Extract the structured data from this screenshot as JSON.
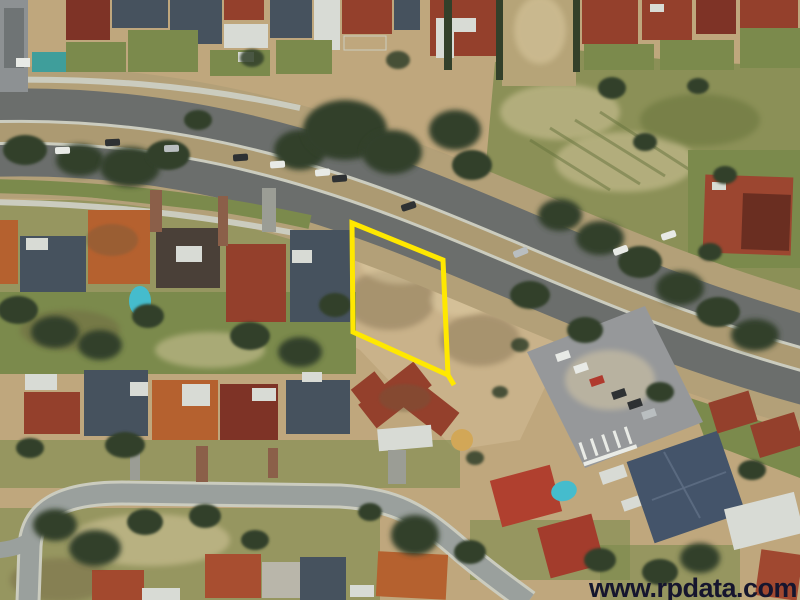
{
  "watermark": {
    "text": "www.rpdata.com"
  },
  "parcel": {
    "points": "352,223 443,260 448,375 353,332",
    "tick_d": "M448,375 L454,385"
  },
  "colors": {
    "ground": "#bfa77d",
    "grass-field": "#8b9057",
    "lot-dirt": "#c9b28a",
    "lawn": "#7b8a4c",
    "tree": "#33402a",
    "road-asphalt": "#6b6e6c",
    "verge-dirt": "#b3a078",
    "median-dirt": "#ac9a72",
    "curb-light": "#cbccbf",
    "street-asphalt": "#9aa09d",
    "parking": "#96989a",
    "building-roof": "#44546a",
    "pool": "#45bccd",
    "roof-red": "#94402c",
    "roof-terracotta": "#b5612f",
    "roof-maroon": "#7e3326",
    "roof-slate": "#46525e",
    "roof-darkbrown": "#4a4038",
    "roof-white": "#d8dbd5",
    "car-white": "#e8eae6",
    "car-dark": "#2e3133",
    "car-silver": "#b9bec0",
    "driveway": "#8b5f49",
    "driveway-gray": "#9b9d95",
    "marking": "#e9ebe6",
    "boundary": "#ffe800",
    "watermark": "#15152e"
  }
}
